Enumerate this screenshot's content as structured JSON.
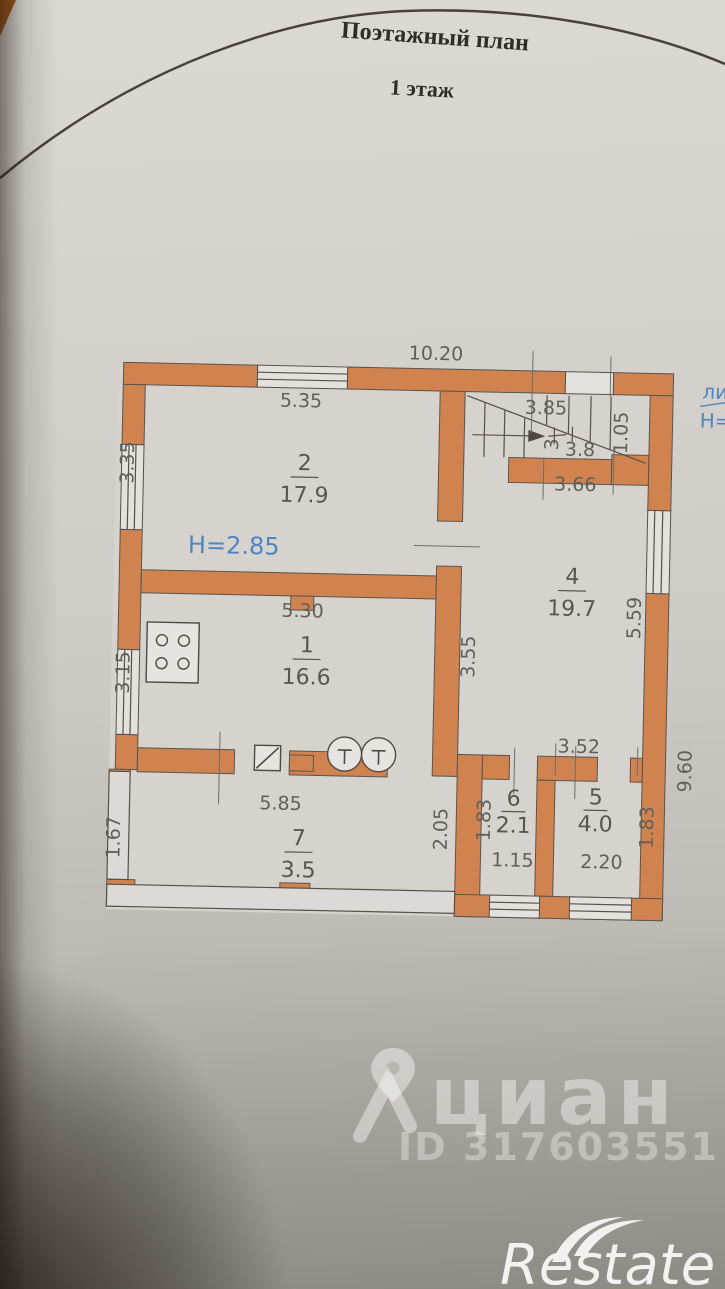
{
  "document": {
    "title": "Поэтажный план",
    "subtitle": "1 этаж"
  },
  "plan": {
    "height_annotation": "Н=2.85",
    "margin_annotation": {
      "line1": "ли",
      "line2": "Н="
    },
    "outer_dimensions": {
      "top": "10.20",
      "right": "9.60"
    },
    "rooms": {
      "room1": {
        "number": "1",
        "area": "16.6"
      },
      "room2": {
        "number": "2",
        "area": "17.9"
      },
      "room4": {
        "number": "4",
        "area": "19.7"
      },
      "room5": {
        "number": "5",
        "area": "4.0"
      },
      "room6": {
        "number": "6",
        "area": "2.1"
      },
      "room7": {
        "number": "7",
        "area": "3.5"
      }
    },
    "dimensions": {
      "room2_width": "5.35",
      "room2_left": "3.35",
      "stair_top": "3.85",
      "stair_mid": "3.8",
      "stair_side": "3",
      "stair_right": "1.05",
      "room4_top": "3.66",
      "room4_left": "3.55",
      "room4_right": "5.59",
      "room1_width": "5.30",
      "room1_left": "3.15",
      "room7_width": "5.85",
      "room7_left": "1.67",
      "room7_right": "2.05",
      "room6_left": "1.83",
      "room6_bottom": "1.15",
      "room5_top": "3.52",
      "room5_bottom": "2.20",
      "room5_right": "1.83"
    }
  },
  "watermark": {
    "brand": "циан",
    "listing_id": "ID 317603551"
  },
  "footer": {
    "brand": "Restate"
  },
  "colors": {
    "wall": "#d0834f",
    "annotation_blue": "#4f86c0",
    "dimension_text": "#605f5a",
    "paper": "#d2cfca"
  }
}
